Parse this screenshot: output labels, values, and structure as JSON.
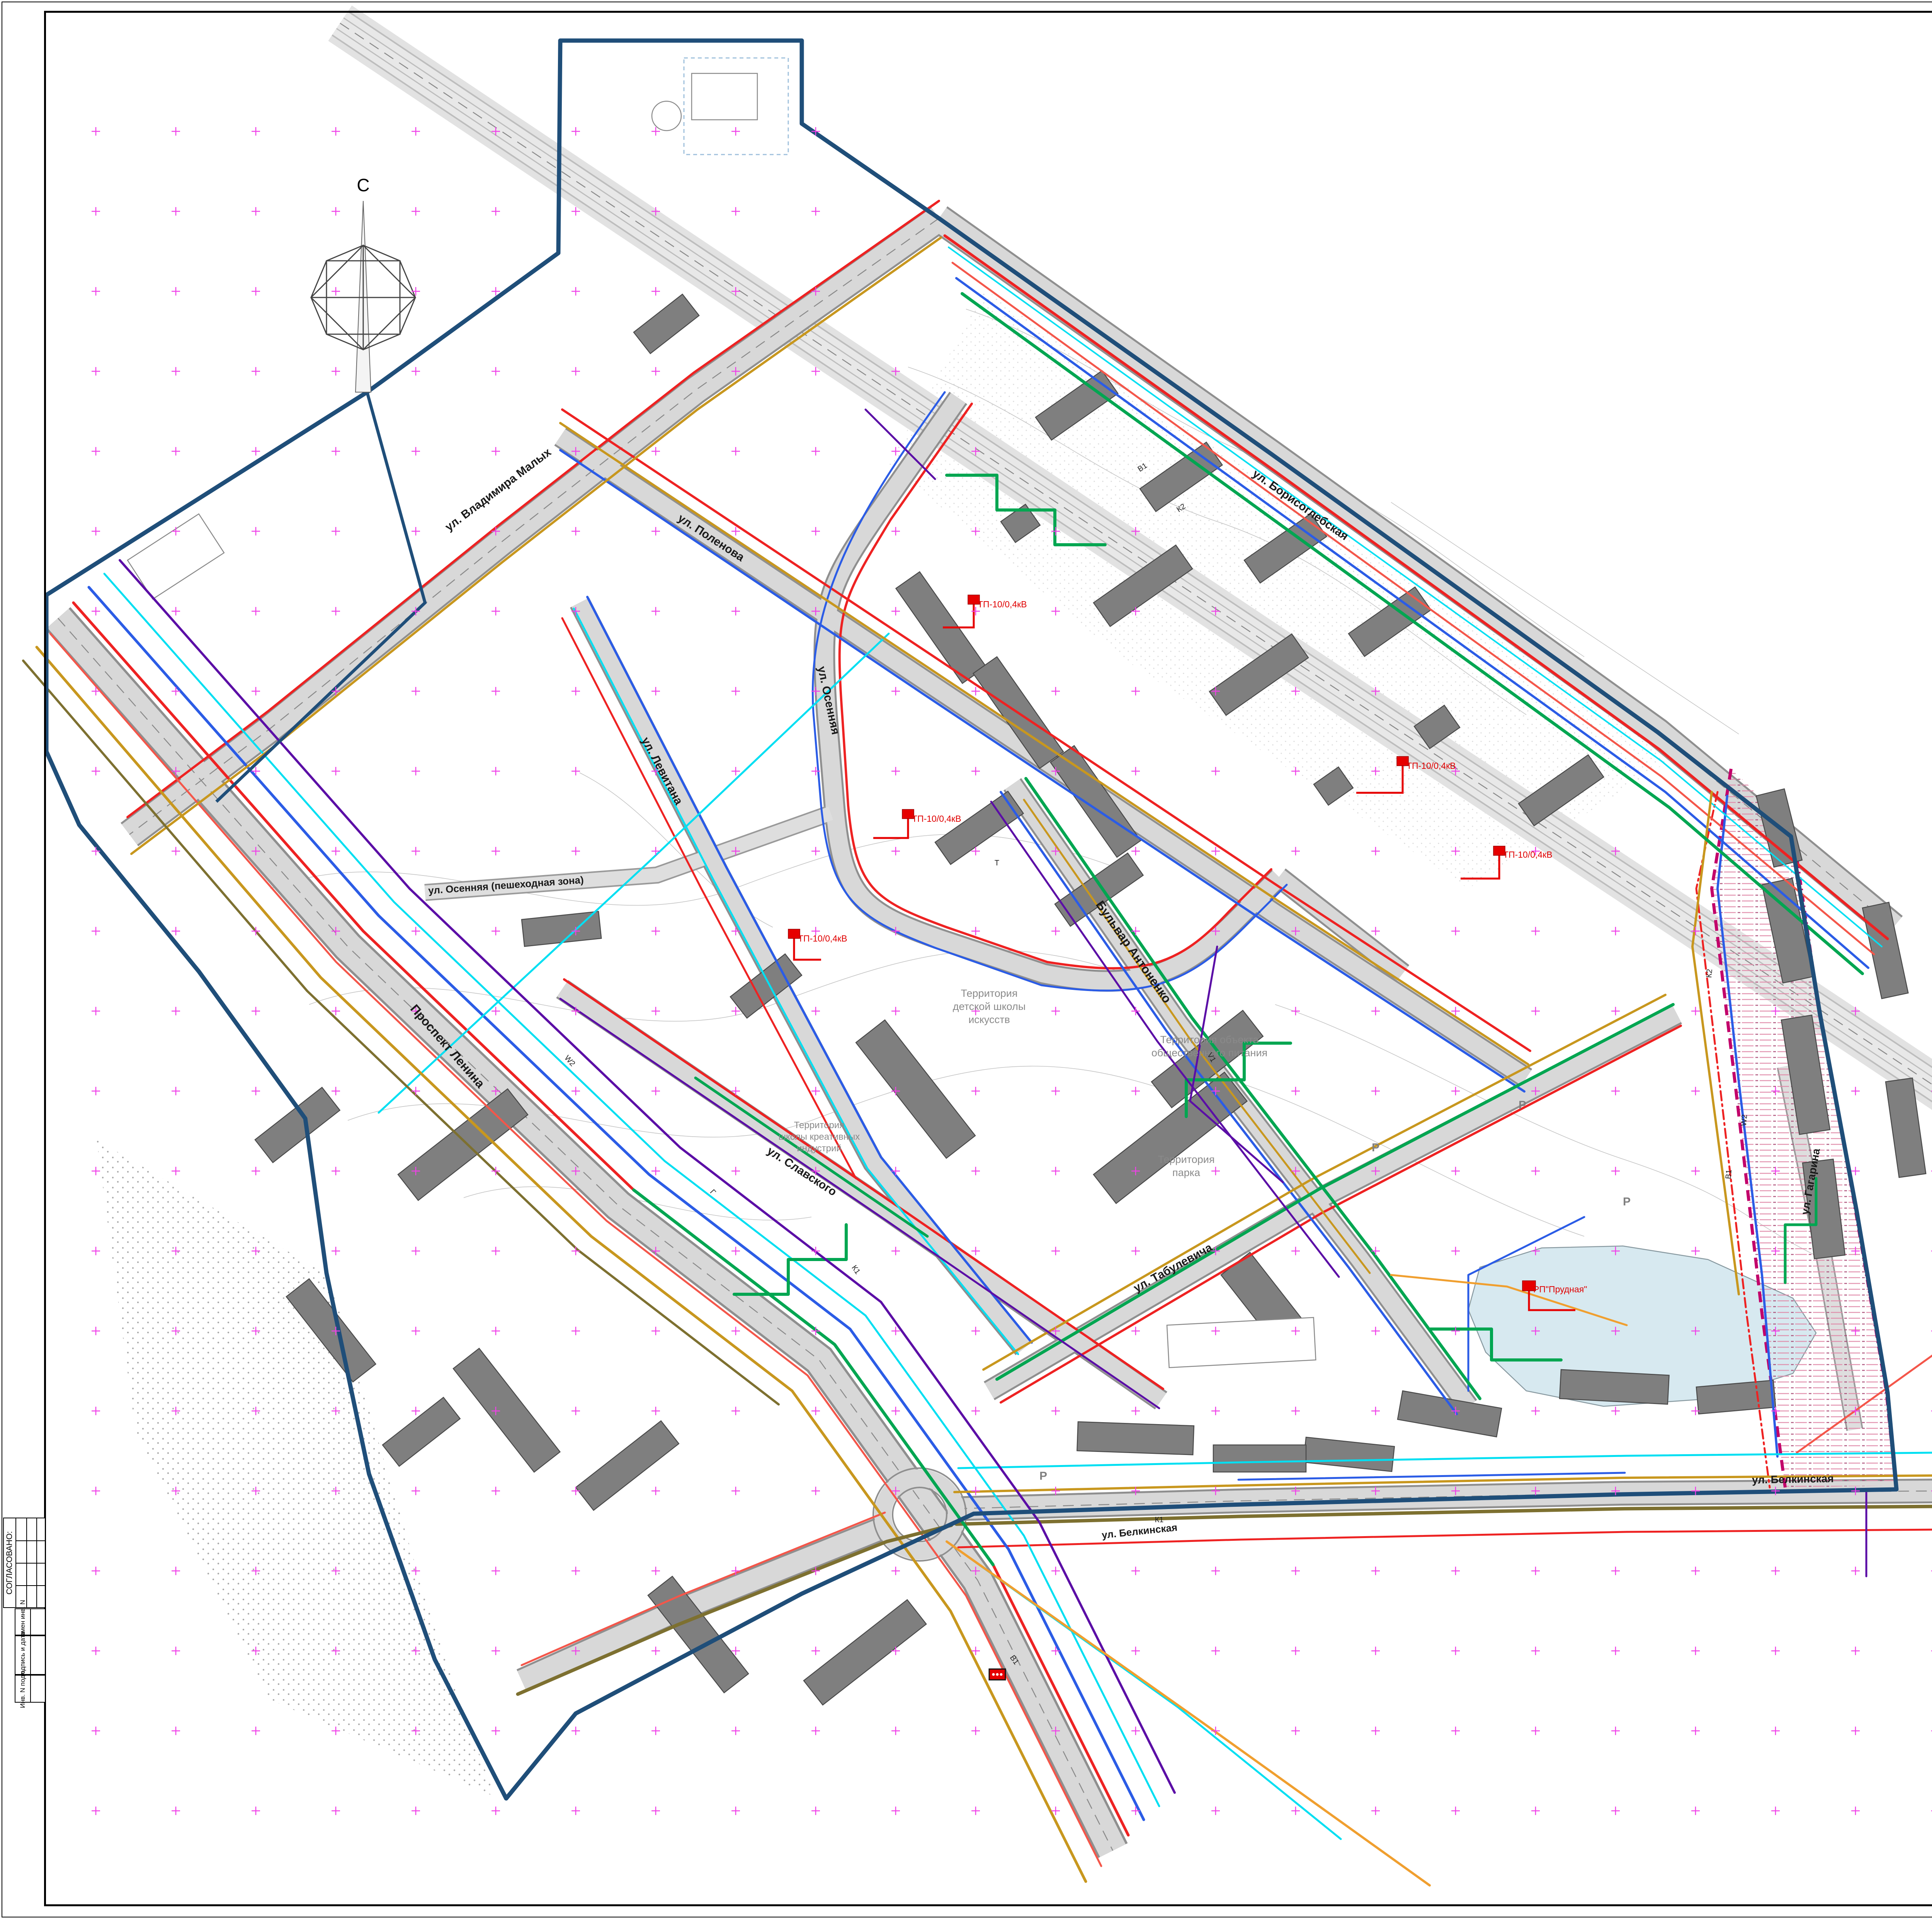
{
  "palette": {
    "red_lines": "#f4564a",
    "boundary": "#1f4e79",
    "zone": "#c2006a",
    "gas": "#00dff2",
    "water": "#2b5ce6",
    "storm_sewer": "#c8971e",
    "sewer": "#7d7030",
    "power": "#ee1111",
    "heat": "#00a651",
    "phone": "#5b0ea6",
    "building": "#7f7f7f",
    "street": "#c9c9c9",
    "pond": "#d7e9f0",
    "cross": "#f03fe8"
  },
  "sheet": {
    "format_label": "Формат А0"
  },
  "corner_title": {
    "line1": "Схема расположения объектов",
    "line2": "инженернной инфраструктуры территории.",
    "line3": "Масштаб 1:2000."
  },
  "legend": {
    "heading": "Условные обозначения",
    "items": [
      {
        "swatch": "line",
        "color": "#f4564a",
        "weight": 8,
        "label": "Красные линии (2025 г)"
      },
      {
        "swatch": "line",
        "color": "#1f4e79",
        "weight": 10,
        "label": "Граница территории ж/района \"Заовражье\""
      },
      {
        "swatch": "zone",
        "label": "Защитная зона регулирования застройки и хозяйственной",
        "label2": "деятельности объекта  культурного наследия \"Усадьба БЕЛКИНО\""
      },
      {
        "swatch": "gas",
        "code": "Г",
        "color": "#00dff2",
        "label": "-Газопроводы ( низкого, среднего и высокого давления)"
      },
      {
        "swatch": "coded",
        "code": "В1",
        "color": "#2b5ce6",
        "label": "-Существующий и проектируемый водопровод"
      },
      {
        "swatch": "coded",
        "code": "К2",
        "color": "#c8971e",
        "label": "-Существующая и проектируемая ливневая канализация"
      },
      {
        "swatch": "coded",
        "code": "К1",
        "color": "#7d7030",
        "label": "-Существующая и проектируемая бытовая канализация"
      },
      {
        "swatch": "power",
        "code": "W2",
        "color": "#ee1111",
        "label": "-Проектируемые высоковольтные электросети",
        "label2": "-Существующая высоковольтная электросеть"
      },
      {
        "swatch": "heat",
        "code": "Т",
        "color": "#00a651",
        "label": "-Проектируемые тепловые сети"
      },
      {
        "swatch": "coded",
        "code": "V1",
        "color": "#5b0ea6",
        "label": "-Проектируемая телефонная канализация"
      },
      {
        "swatch": "buildings",
        "label": "-Существующие, строящиеся и проектируемые здания и сооружения"
      },
      {
        "swatch": "osl",
        "label": "- Очистные сооружения ливневых стоков"
      },
      {
        "swatch": "street",
        "label": "-Улицы с твердым покрытием"
      }
    ]
  },
  "notes": {
    "line1": "Инженерные сети на чертеже  показаны ориентировочно на уровне  схем и их  расположения в",
    "line2": "пределах  улиц, дорог  и проездов ж/района.",
    "line3": "Данный чертеж выполнен в масштабе 1:1000,  При печати на формат  А0 - масштаб 1:2500"
  },
  "map": {
    "north_label": "С",
    "street_labels": [
      "ул. Владимира  Малых",
      "ул. Борисоглебская",
      "ул. Поленова",
      "ул. Осенняя",
      "ул. Осенняя (пешеходная зона)",
      "ул. Левитана",
      "Проспект Ленина",
      "ул. Славского",
      "ул. Табулевича",
      "Бульвар Антоненко",
      "ул. Белкинская",
      "ул. Белкинская",
      "ул. Гагарина"
    ],
    "territory_labels": [
      [
        "Территория",
        "детской школы",
        "искусств"
      ],
      [
        "Территория объекта",
        "общественного питания"
      ],
      [
        "Территория",
        "школы креативных",
        "индустрий"
      ],
      [
        "Территория",
        "парка"
      ]
    ],
    "tp_labels": [
      "ТП-10/0,4кВ",
      "ТП-10/0,4кВ",
      "ТП-10/0,4кВ",
      "ТП-10/0,4кВ",
      "ТП-10/0,4кВ",
      "РП\"Прудная\""
    ],
    "line_marks": [
      "В1",
      "К2",
      "К1",
      "W2",
      "V1",
      "Т",
      "Г",
      "В1",
      "К2",
      "W2",
      "К1",
      "В1"
    ],
    "parking_label": "Р"
  },
  "side_stamp": {
    "approved": "СОГЛАСОВАНО:",
    "replace_inv": "Взамен инв. N",
    "sign_date": "Подпись и дата",
    "inv_no": "Инв. N подл."
  },
  "title_block": {
    "doc_code": "2021/01.09 - ППТ",
    "project_l1": "Проект по внесению изменений  в документацию по",
    "project_l2": "планировке территории",
    "project_l3": "жилого района \"Заовражье\" в г.Обнинск  Калужской области",
    "materials_l1": "Материалы по обоснованию проекта",
    "materials_l2": "планировки территории",
    "sheet_name_l1": "Схема расположения объектов",
    "sheet_name_l2": "инженерной инфраструктуры",
    "sheet_name_l3": "территории.",
    "stage_label": "Стадия",
    "sheet_label": "Лист",
    "sheets_label": "Листов",
    "stage_value": "ППТ",
    "sheet_value": "9",
    "company": "ООО \"КМК-2\"",
    "company_city": "г.Минск",
    "logo_text": "К2К",
    "col_izm": "Изм.",
    "col_kol": "Колич.",
    "col_list": "Лист",
    "col_ndoc": "№ док",
    "col_sign": "Подпись",
    "col_date": "Дата",
    "rows": [
      {
        "role": "ГИП",
        "name": "Одаренко",
        "date": "12.25"
      },
      {
        "role": "ГАП",
        "name": "Мерзляков",
        "date": "12.25"
      },
      {
        "role": "Разраб.",
        "name": "Мерзляков",
        "date": "12.25"
      },
      {
        "role": "Н.контр.",
        "name": "Одаренко",
        "date": "12.25"
      }
    ]
  }
}
